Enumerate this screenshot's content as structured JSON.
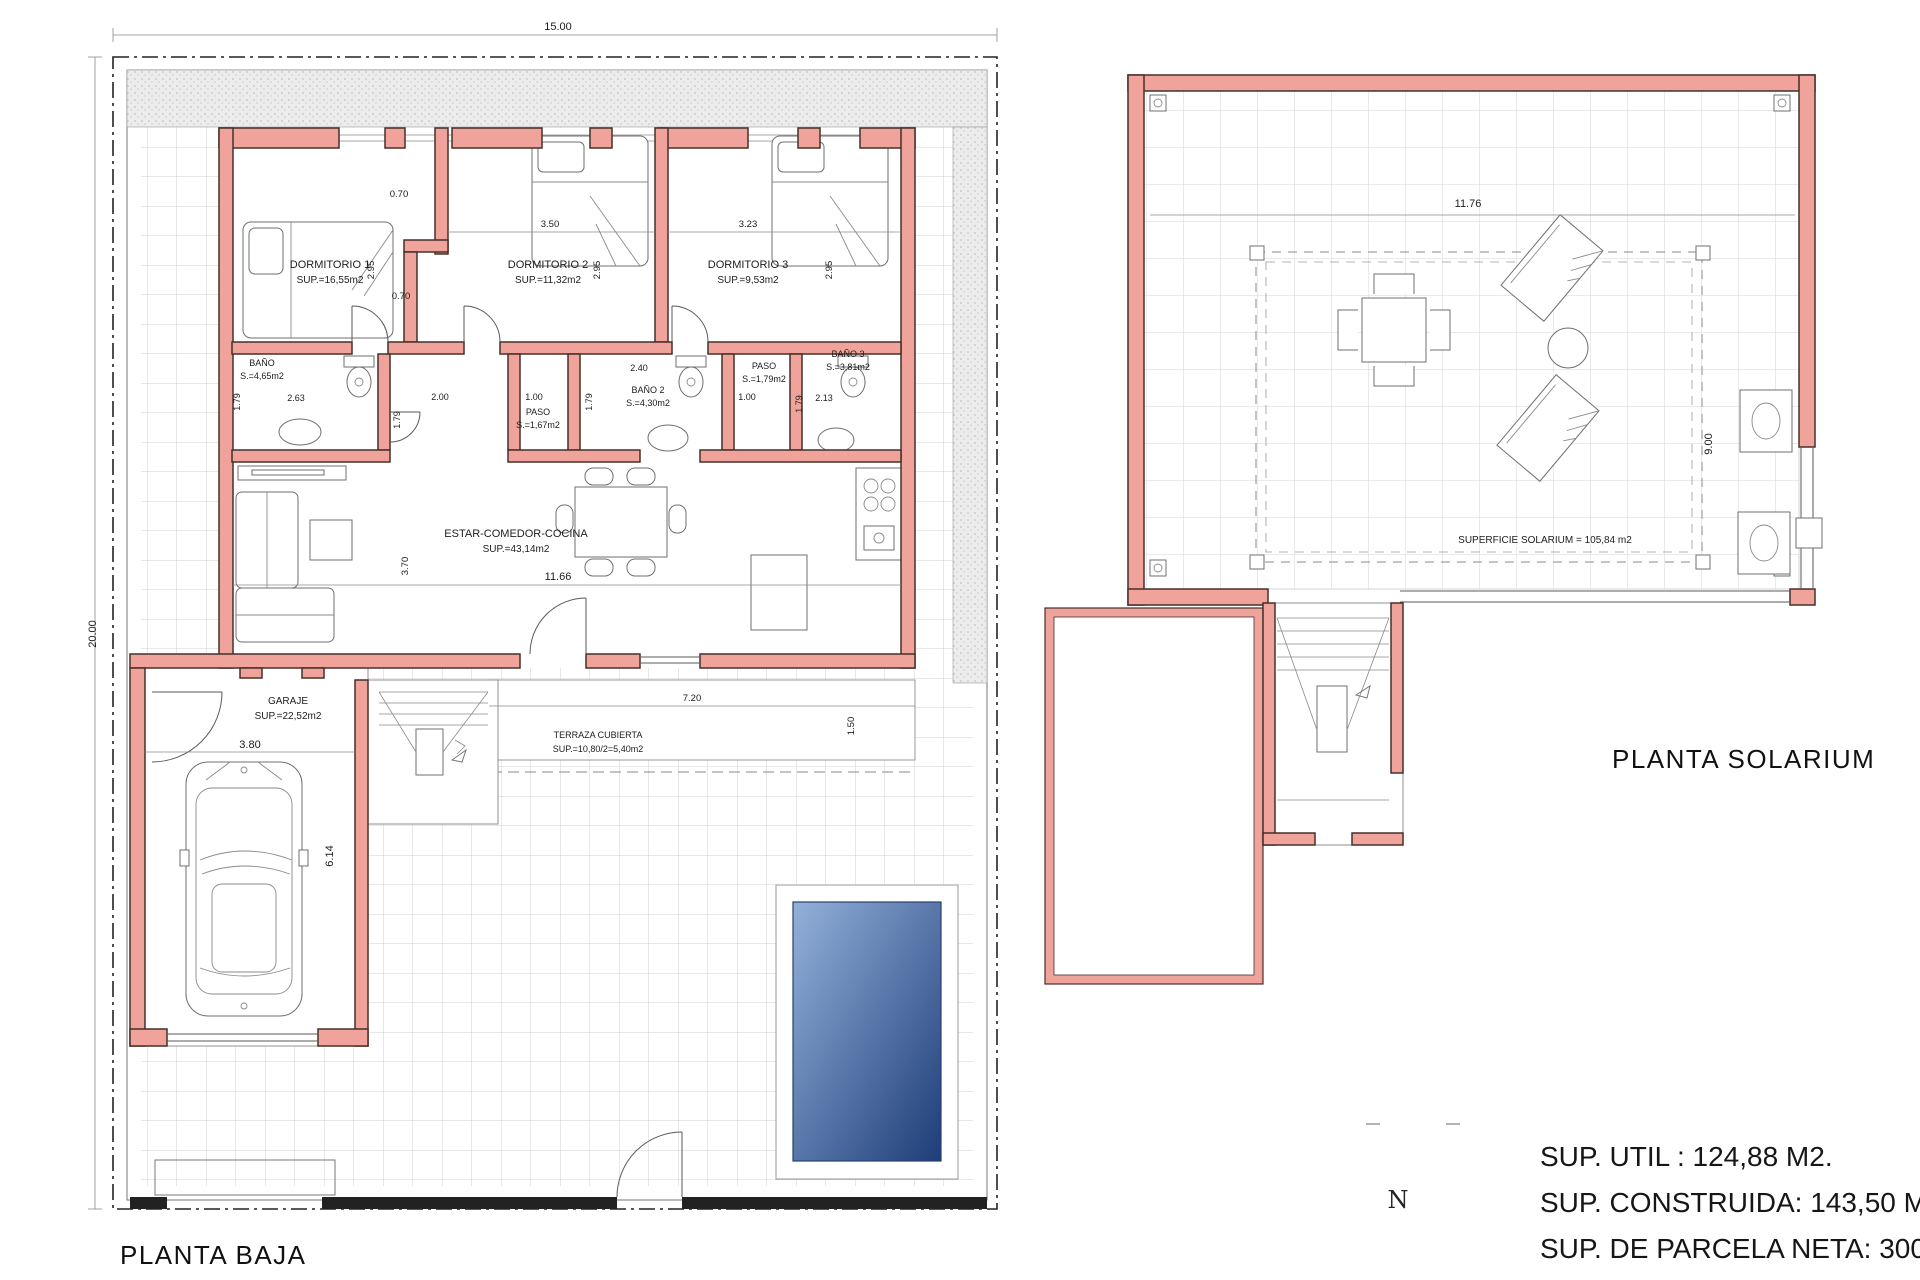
{
  "titles": {
    "baja": "PLANTA BAJA",
    "solarium": "PLANTA SOLARIUM"
  },
  "summary": {
    "line1": "SUP. UTIL : 124,88 M2.",
    "line2": "SUP. CONSTRUIDA: 143,50 M2.",
    "line3": "SUP. DE PARCELA NETA: 300,00 M2."
  },
  "north_label": "N",
  "baja": {
    "dim_top": "15.00",
    "dim_left": "20.00",
    "dorm1": {
      "name": "DORMITORIO 1",
      "area": "SUP.=16,55m2",
      "w": "2.95"
    },
    "dorm2": {
      "name": "DORMITORIO 2",
      "area": "SUP.=11,32m2",
      "w": "2.95",
      "l": "3.50"
    },
    "dorm3": {
      "name": "DORMITORIO 3",
      "area": "SUP.=9,53m2",
      "w": "2.95",
      "l": "3.23"
    },
    "nook1": "0.70",
    "nook2": "0.70",
    "bano1": {
      "name": "BAÑO",
      "area": "S.=4,65m2",
      "l": "2.63",
      "w": "1.79"
    },
    "hall": {
      "l": "2.00",
      "w": "1.79"
    },
    "paso1": {
      "name": "PASO",
      "area": "S.=1,67m2",
      "l": "1.00"
    },
    "bano2": {
      "name": "BAÑO 2",
      "area": "S.=4,30m2",
      "l": "2.40",
      "w": "1.79"
    },
    "paso2": {
      "name": "PASO",
      "area": "S.=1,79m2",
      "l": "1.00"
    },
    "bano3": {
      "name": "BAÑO 3",
      "area": "S.=3,81m2",
      "l": "2.13",
      "w": "1.79"
    },
    "estar": {
      "name": "ESTAR-COMEDOR-COCINA",
      "area": "SUP.=43,14m2",
      "l": "11.66",
      "w": "3.70"
    },
    "garaje": {
      "name": "GARAJE",
      "area": "SUP.=22,52m2",
      "l": "3.80",
      "w": "6.14"
    },
    "terraza": {
      "name": "TERRAZA CUBIERTA",
      "area": "SUP.=10,80/2=5,40m2",
      "l": "7.20",
      "w": "1.50"
    }
  },
  "solarium": {
    "dim_top": "11.76",
    "dim_right": "9.00",
    "label": "SUPERFICIE SOLARIUM = 105,84 m2"
  },
  "colors": {
    "wall_fill": "#F0A39B",
    "wall_stroke": "#46302A",
    "pool_light": "#93B1DA",
    "pool_dark": "#1E3D78"
  }
}
